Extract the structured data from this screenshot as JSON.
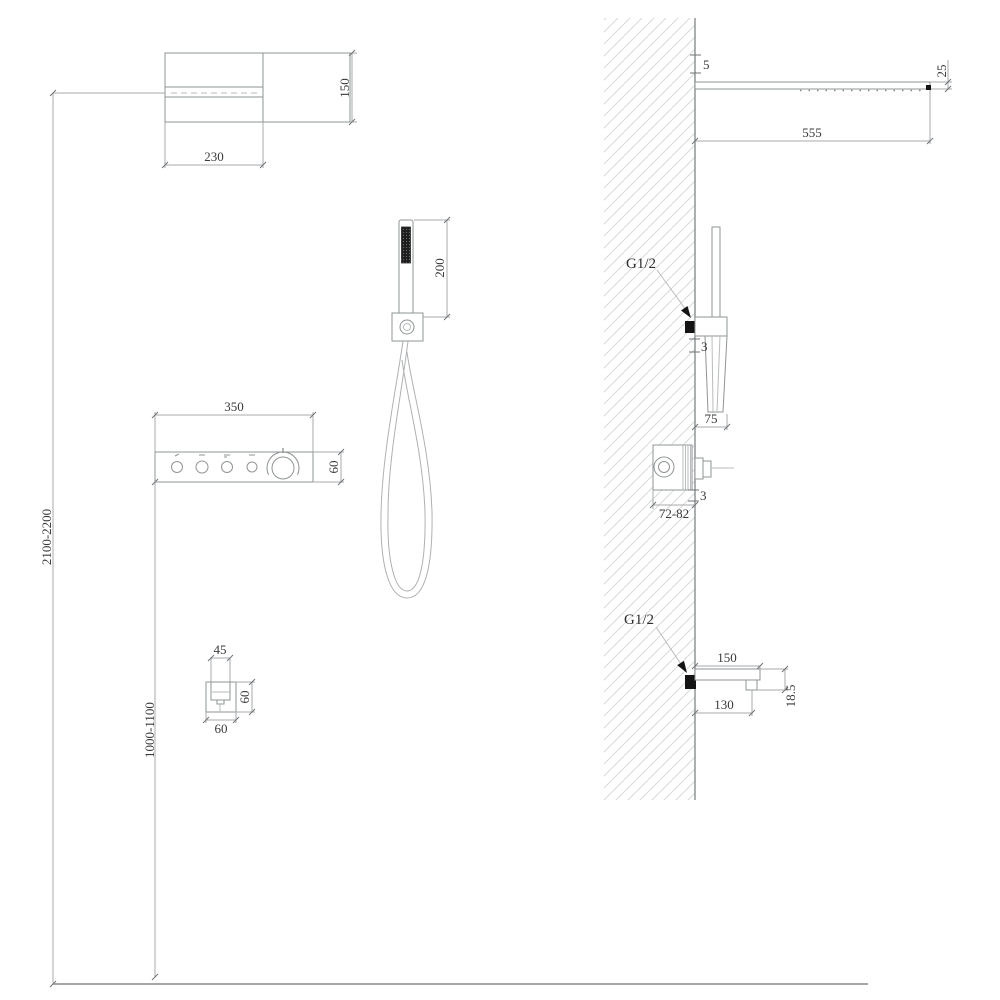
{
  "front_view": {
    "head_width": "230",
    "head_height": "150",
    "handshower_length": "200",
    "panel_width": "350",
    "panel_height": "60",
    "spout_width": "45",
    "spout_plate_height": "60",
    "spout_plate_width": "60",
    "install_height": "2100-2200",
    "panel_height_from_floor": "1000-1100"
  },
  "side_view": {
    "head_wall_gap": "5",
    "head_length": "555",
    "head_thickness": "25",
    "handshower_inlet": "G1/2",
    "handshower_wall_gap": "3",
    "handshower_depth": "75",
    "valve_depth": "72-82",
    "valve_wall_gap": "3",
    "spout_inlet": "G1/2",
    "spout_length": "150",
    "spout_outlet_offset": "130",
    "spout_drop": "18.5"
  }
}
